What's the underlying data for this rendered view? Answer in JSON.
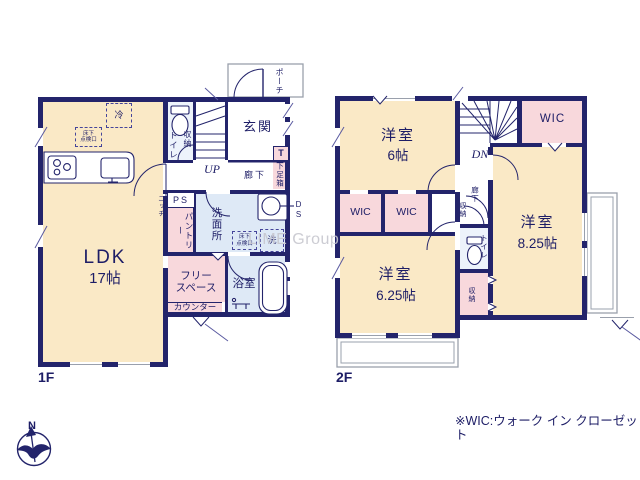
{
  "title": "2-story house floor plan",
  "floor1": {
    "floor_label": "1F",
    "rooms": {
      "ldk_name": "LDK",
      "ldk_size": "17帖",
      "entrance": "玄関",
      "porch": "ポーチ",
      "toilet": "トイレ",
      "toilet_storage": "収納",
      "stairs_dir": "UP",
      "hallway": "廊下",
      "shoe_t": "T",
      "shoe_box": "下足箱",
      "ps": "PS",
      "pantry": "パントリー",
      "washroom": "洗面所",
      "duct": "DS",
      "laundry": "洗",
      "hatch_label": "床下\n点検口",
      "fridge": "冷",
      "niche": "ニッチ",
      "bath": "浴室",
      "free_space": "フリー\nスペース",
      "counter": "カウンター"
    }
  },
  "floor2": {
    "floor_label": "2F",
    "rooms": {
      "west_room_name": "洋室",
      "west_room_size": "6帖",
      "wic_ne": "WIC",
      "wic_sw1": "WIC",
      "wic_sw2": "WIC",
      "stairs_dir": "DN",
      "hallway": "廊下",
      "hall_storage": "収納",
      "east_room_name": "洋室",
      "east_room_size": "8.25帖",
      "south_room_name": "洋室",
      "south_room_size": "6.25帖",
      "toilet": "トイレ",
      "south_storage": "収納"
    }
  },
  "footer": {
    "wic_note": "※WIC:ウォーク イン クローゼット"
  },
  "compass": {
    "north_label": "N"
  },
  "watermark": "LIME Group",
  "colors": {
    "wall": "#23246b",
    "text": "#1d1d66",
    "room_cream": "#FAE9C6",
    "room_pink": "#F8D8DC",
    "room_blue": "#DEE9F6",
    "balcony_line": "#9aa0ac",
    "watermark": "#c7c7cf"
  }
}
